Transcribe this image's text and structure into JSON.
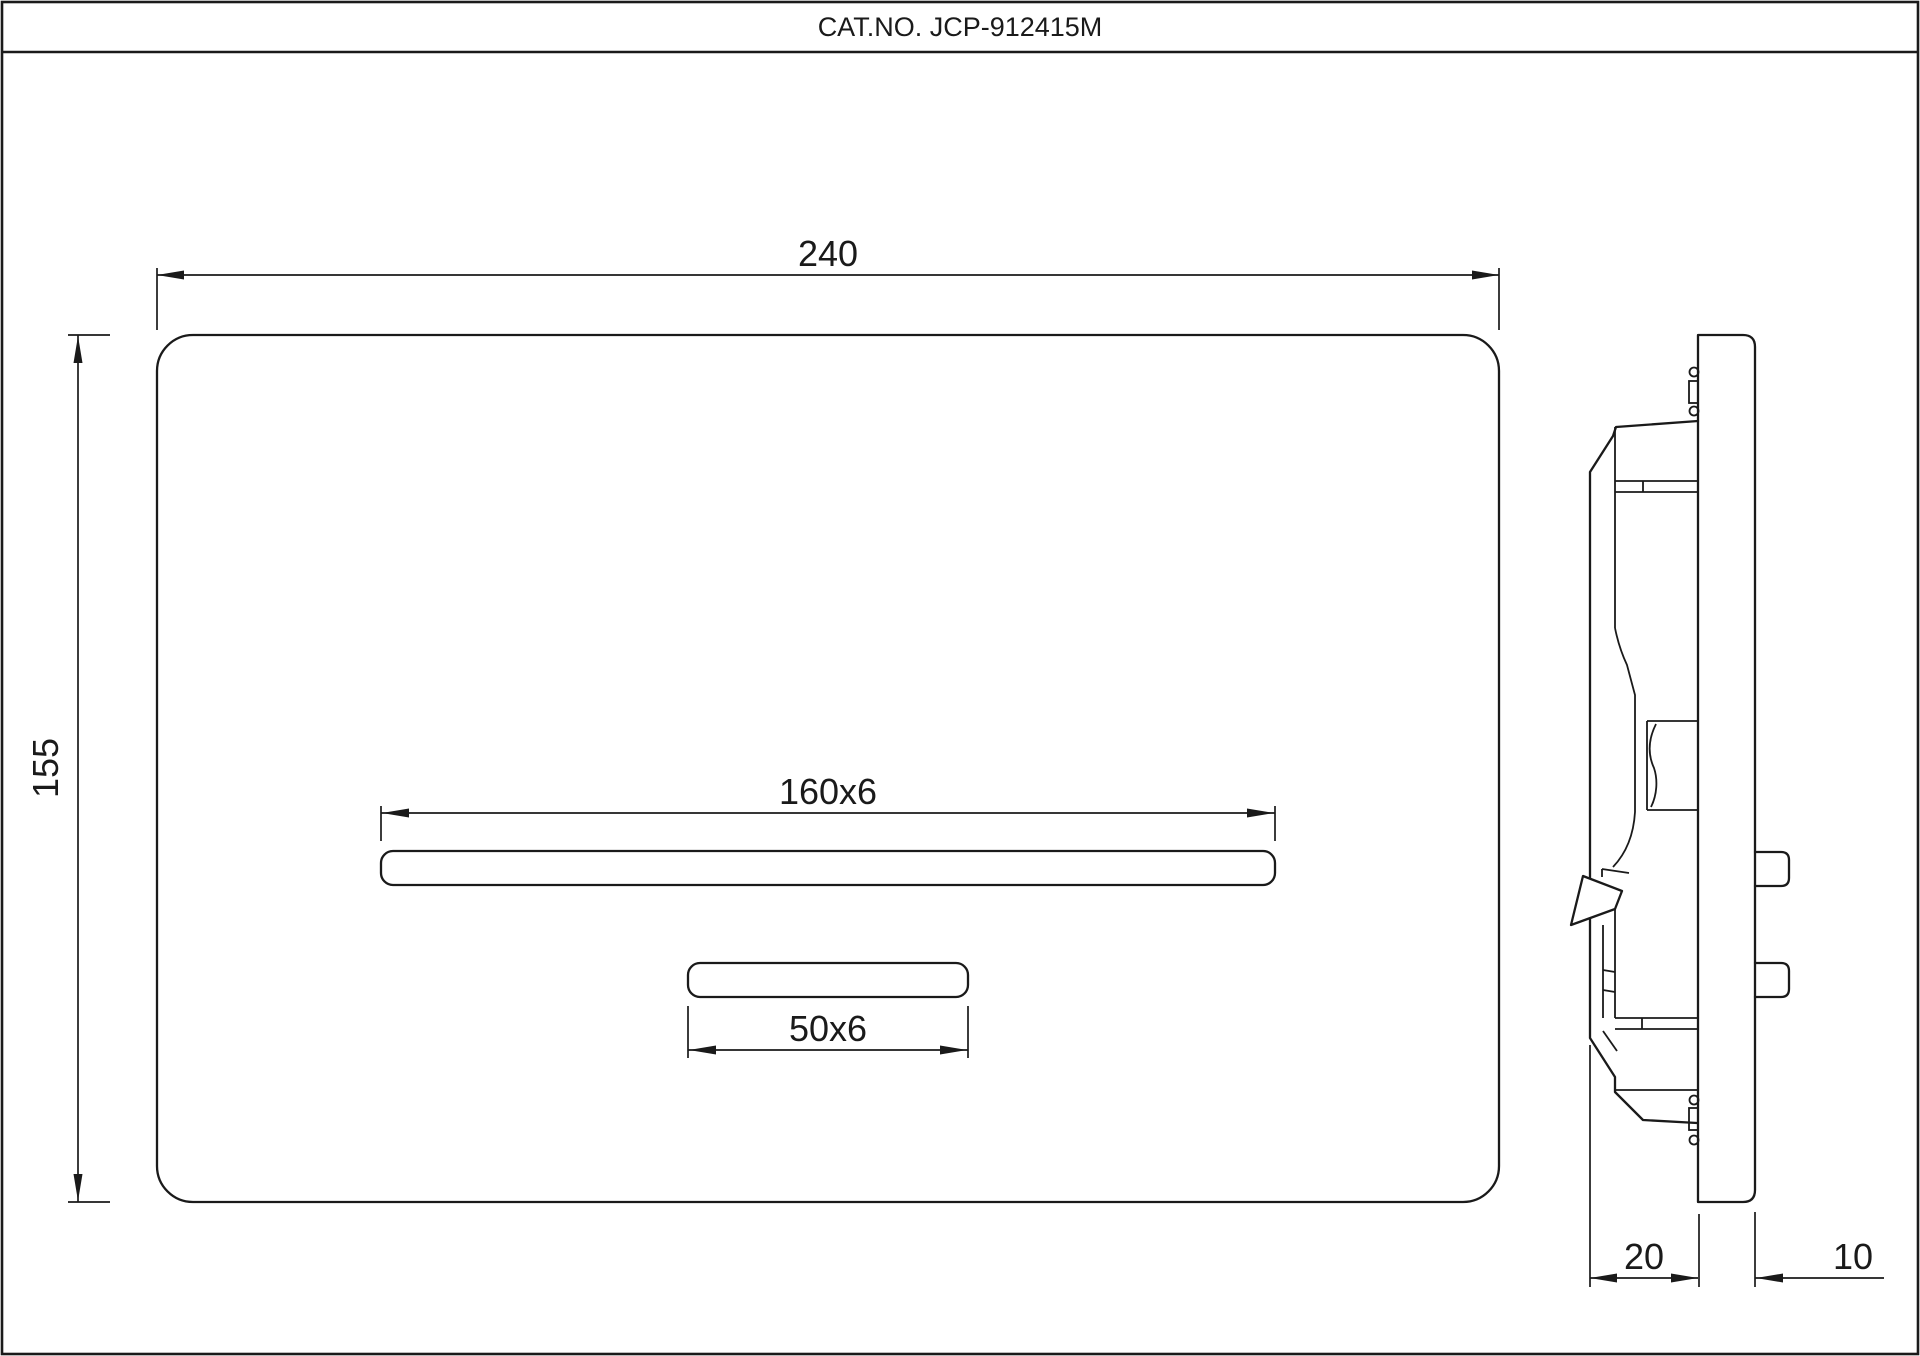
{
  "sheet": {
    "title": "CAT.NO. JCP-912415M"
  },
  "front_view": {
    "name": "flush-plate-front-view",
    "width_dim": "240",
    "height_dim": "155",
    "large_slot_dim": "160x6",
    "small_slot_dim": "50x6"
  },
  "side_view": {
    "name": "flush-plate-side-view",
    "body_depth_dim": "20",
    "plate_thickness_dim": "10"
  },
  "colors": {
    "line": "#1a1a1a",
    "background": "#ffffff"
  }
}
